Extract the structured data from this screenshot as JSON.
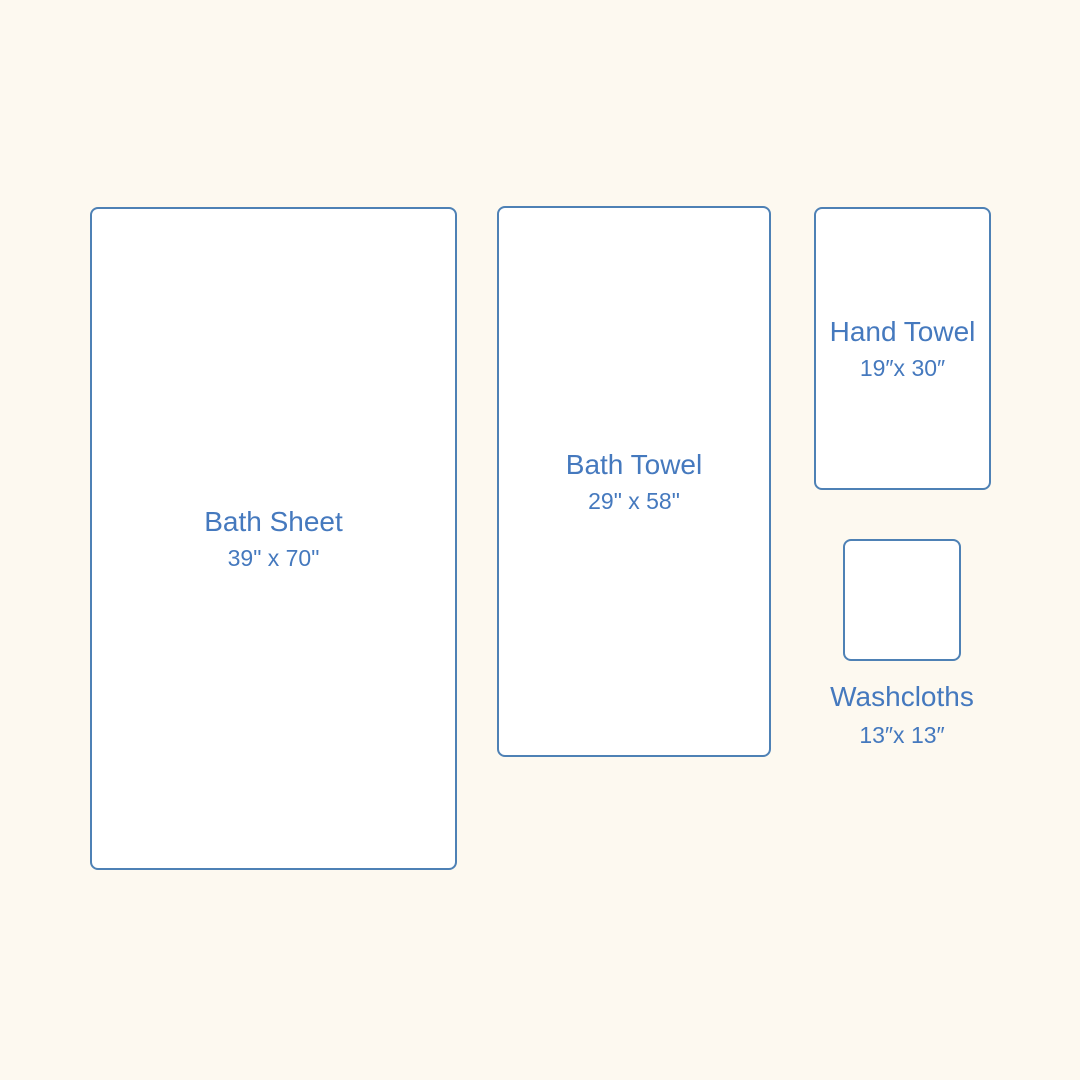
{
  "palette": {
    "background": "#FDF9F0",
    "box_fill": "#FFFFFF",
    "box_border": "#4E81B5",
    "label_text": "#4579BE"
  },
  "items": [
    {
      "name": "Bath Sheet",
      "dimensions": "39\" x 70\""
    },
    {
      "name": "Bath Towel",
      "dimensions": "29\" x 58\""
    },
    {
      "name": "Hand Towel",
      "dimensions": "19″x 30″"
    },
    {
      "name": "Washcloths",
      "dimensions": "13″x 13″"
    }
  ]
}
